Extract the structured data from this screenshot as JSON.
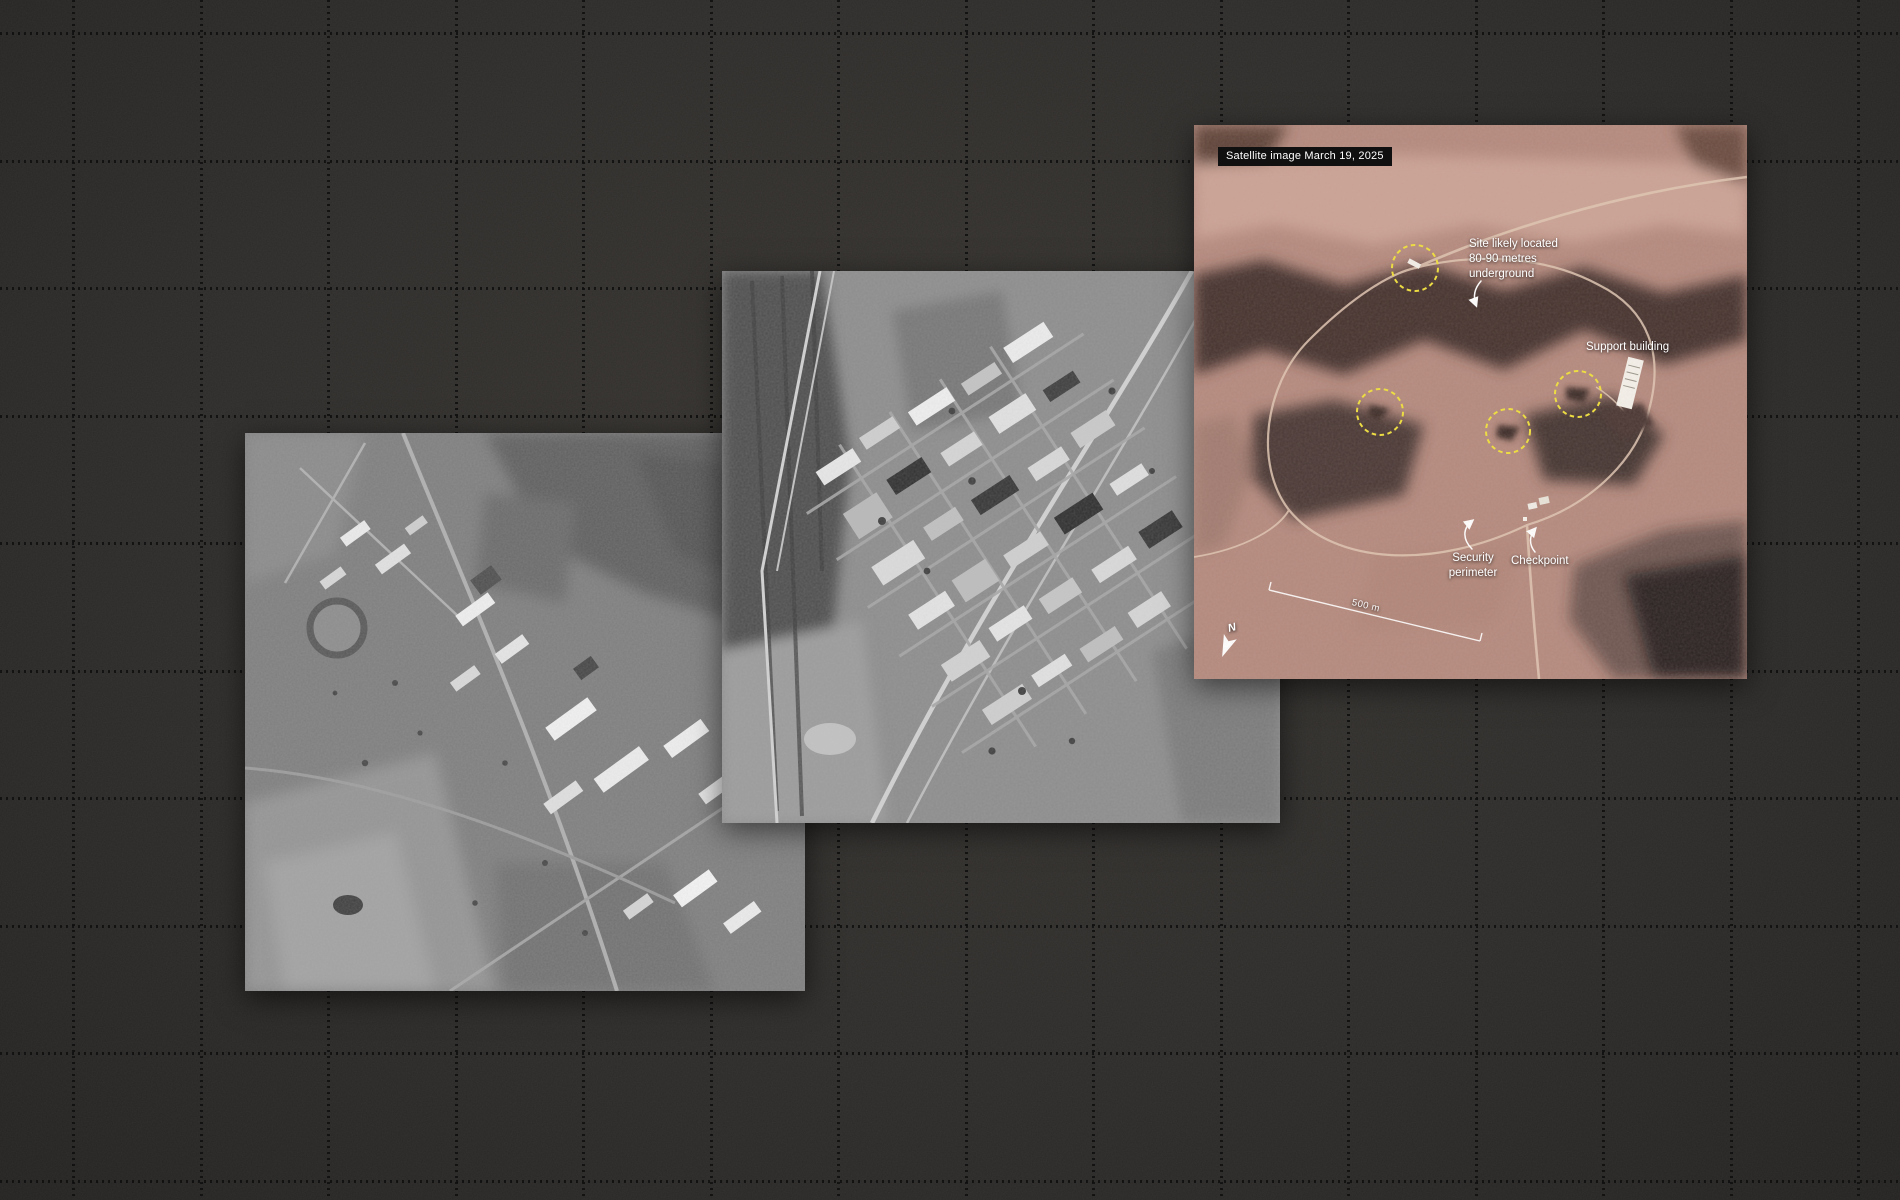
{
  "canvas": {
    "background_color": "#2e2c2a",
    "grid_color": "#0a0a0a"
  },
  "annotated_photo": {
    "caption_badge": "Satellite image March 19, 2025",
    "labels": {
      "underground_site": "Site likely located 80-90 metres underground",
      "support_building": "Support building",
      "security_perimeter": "Security perimeter",
      "checkpoint": "Checkpoint",
      "scale_bar": "500 m",
      "north_indicator": "N"
    },
    "highlight_color": "#efdf3a",
    "annotation_text_color": "#ffffff",
    "badge_background": "#101010"
  }
}
